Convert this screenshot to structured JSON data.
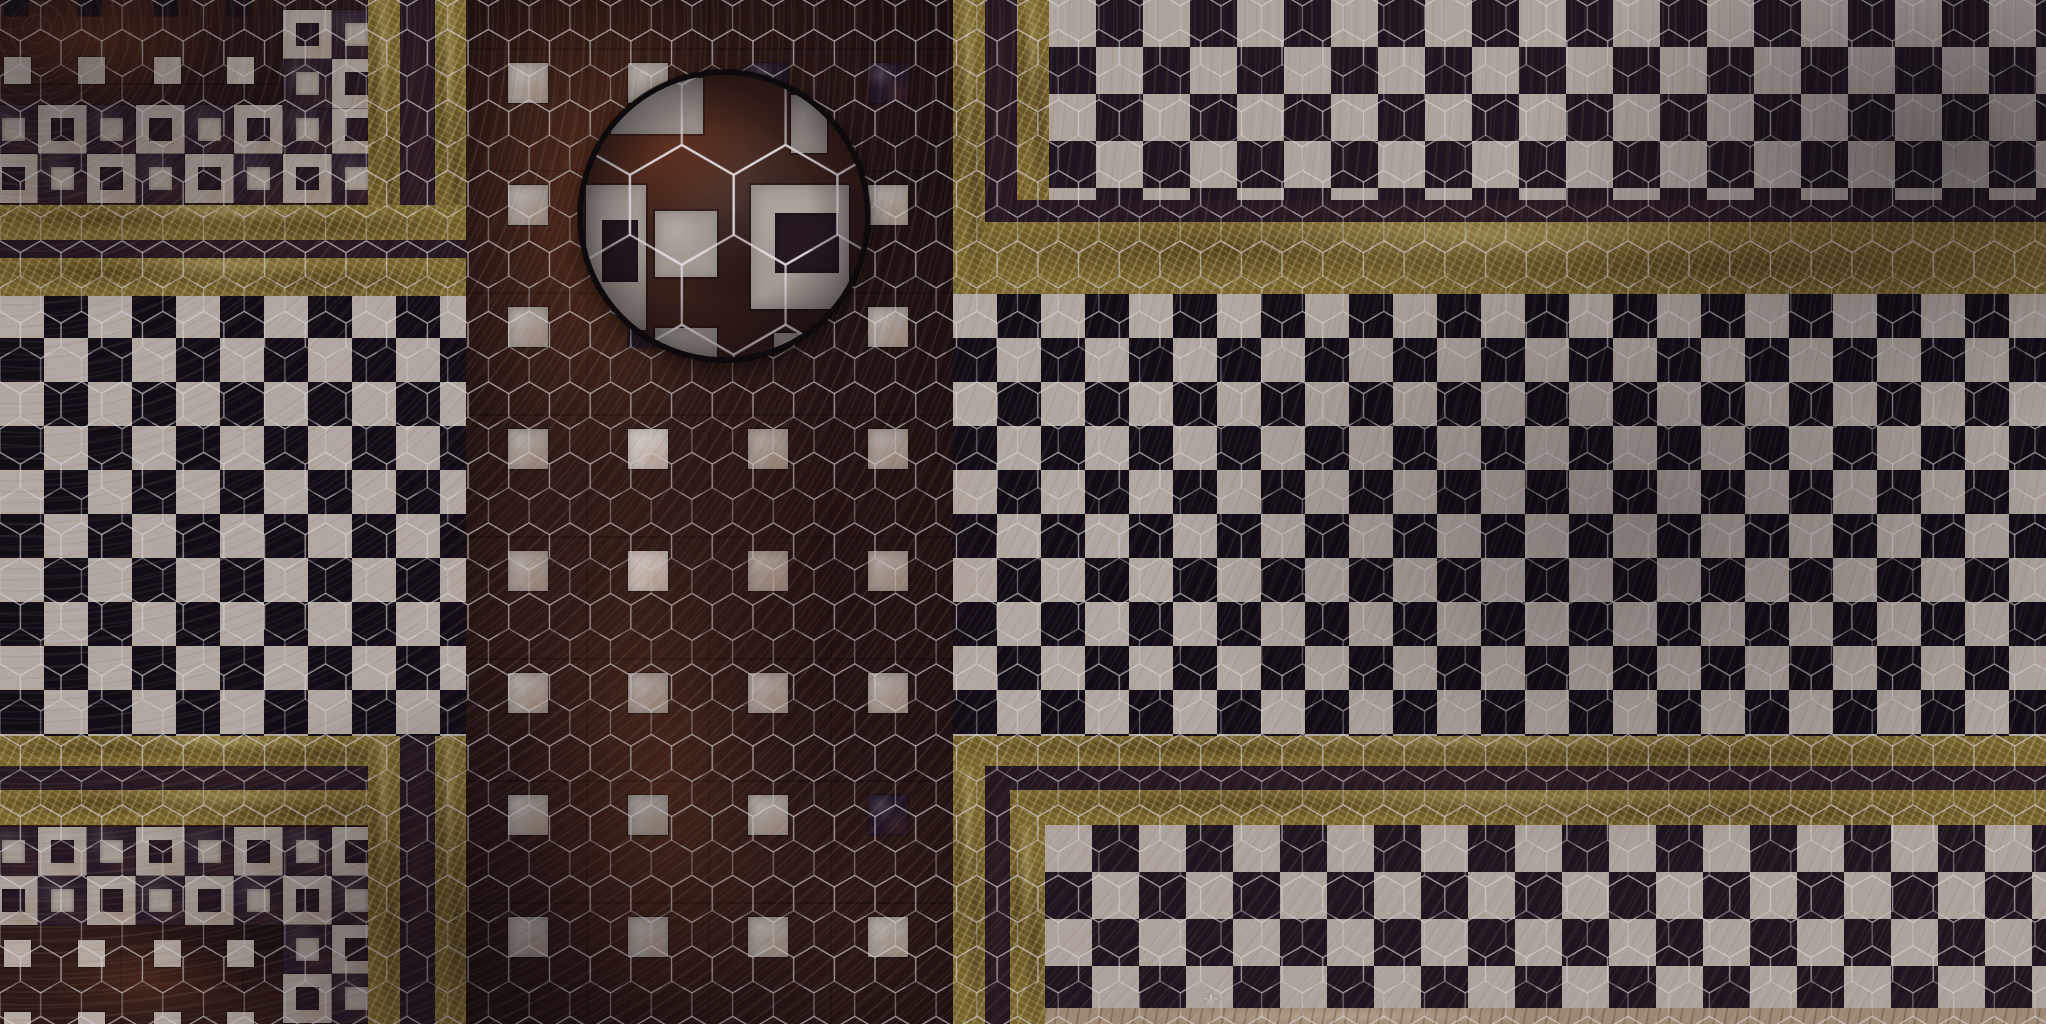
{
  "artwork": {
    "type": "tabletop battlemap floor texture",
    "style": "victorian marble mosaic floor with hexagonal battle-grid overlay and circular zoom inset"
  },
  "palette": {
    "rust_base": "#2c1a17",
    "rust_warm": "#6b3a24",
    "near_black": "#120c17",
    "marble": "#b1a8a1",
    "marble_dim": "#a39a93",
    "marble_bright": "#ccc5bf",
    "gold": "#75622c",
    "gold_vein": "#d6c88c",
    "gap": "#241722",
    "hex_line": "#d9d3d7",
    "tan": "#9d8a76",
    "ring": "#0d090c",
    "diamond_dark": "#1f1520",
    "diamond_light": "#ada49e"
  },
  "hex_grid": {
    "cell_width": 40.7,
    "row_period": 35.25,
    "inset_scale": 2.55,
    "line_color": "#d9d3d7"
  },
  "checker": {
    "square_px": 44
  },
  "diamond": {
    "cell_px": 94
  },
  "center_column": {
    "square_size": 40,
    "col_x": [
      508,
      628,
      748,
      868
    ],
    "row_y": [
      63,
      185,
      307,
      429,
      551,
      673,
      795,
      917
    ],
    "cells": [
      [
        "L",
        "L",
        "D",
        "D"
      ],
      [
        "L",
        "D",
        "D",
        "L"
      ],
      [
        "L",
        "D",
        "L",
        "L"
      ],
      [
        "L",
        "B",
        "L",
        "L"
      ],
      [
        "L",
        "B",
        "L",
        "L"
      ],
      [
        "L",
        "L",
        "L",
        "L"
      ],
      [
        "L",
        "L",
        "L",
        "D"
      ],
      [
        "L",
        "L",
        "L",
        "L"
      ]
    ]
  },
  "corner_panels": {
    "top_left": {
      "hollow": {
        "row_y": [
          105,
          154
        ],
        "x_start": -11,
        "pitch": 49,
        "cols": 8,
        "row_phase": [
          "D",
          "L"
        ]
      },
      "side_cells": [
        {
          "x": 283,
          "y": 10,
          "t": "L"
        },
        {
          "x": 332,
          "y": 10,
          "t": "D"
        },
        {
          "x": 283,
          "y": 59,
          "t": "D"
        },
        {
          "x": 332,
          "y": 59,
          "t": "L"
        }
      ],
      "accents": [
        {
          "t": "dark",
          "y": -8,
          "xs": [
            4,
            78,
            154,
            227
          ]
        },
        {
          "t": "light",
          "y": 57,
          "xs": [
            4,
            78,
            154,
            227
          ]
        }
      ]
    },
    "bottom_left": {
      "hollow": {
        "row_y": [
          827,
          876
        ],
        "x_start": -11,
        "pitch": 49,
        "cols": 8,
        "row_phase": [
          "D",
          "L"
        ]
      },
      "side_cells": [
        {
          "x": 283,
          "y": 925,
          "t": "D"
        },
        {
          "x": 332,
          "y": 925,
          "t": "L"
        },
        {
          "x": 283,
          "y": 974,
          "t": "L"
        },
        {
          "x": 332,
          "y": 974,
          "t": "D"
        }
      ],
      "accents": [
        {
          "t": "light",
          "y": 940,
          "xs": [
            4,
            78,
            154,
            227
          ]
        },
        {
          "t": "light",
          "y": 1012,
          "xs": [
            4,
            78,
            154,
            227
          ]
        }
      ]
    }
  },
  "inset": {
    "cx": 724,
    "cy": 216,
    "r": 146,
    "tiles": [
      {
        "x": 33,
        "y": 8,
        "w": 92,
        "h": 56,
        "hole": null
      },
      {
        "x": 213,
        "y": 25,
        "w": 36,
        "h": 58,
        "hole": null
      },
      {
        "x": 8,
        "y": 115,
        "w": 60,
        "h": 145,
        "hole": {
          "x": 24,
          "y": 150,
          "w": 36,
          "h": 62
        }
      },
      {
        "x": 77,
        "y": 141,
        "w": 62,
        "h": 66,
        "hole": null
      },
      {
        "x": 173,
        "y": 115,
        "w": 98,
        "h": 124,
        "hole": {
          "x": 197,
          "y": 143,
          "w": 64,
          "h": 60
        }
      },
      {
        "x": 77,
        "y": 258,
        "w": 62,
        "h": 34,
        "hole": null
      },
      {
        "x": 196,
        "y": 263,
        "w": 74,
        "h": 29,
        "hole": null
      }
    ]
  },
  "watermark": {
    "glyph": "⚜"
  }
}
